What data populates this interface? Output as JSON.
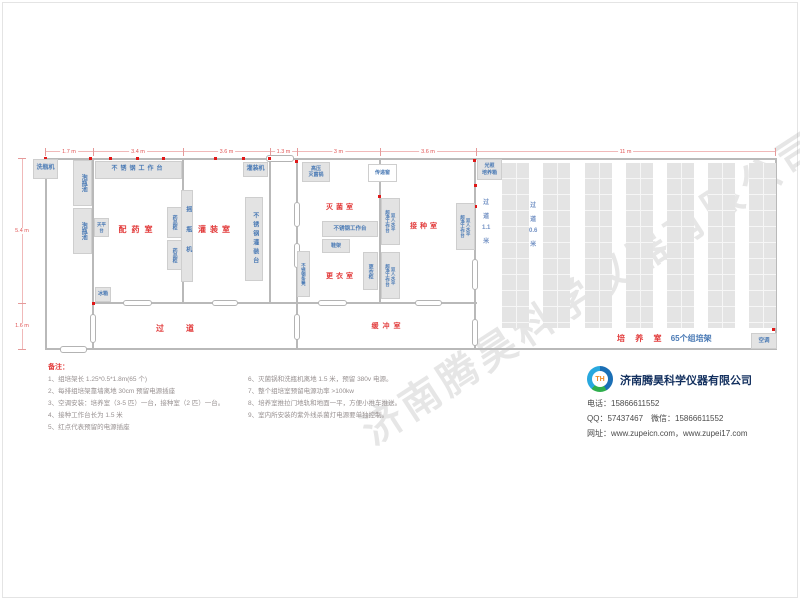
{
  "watermark": "济南腾昊科学仪器有限公司",
  "diagram": {
    "colors": {
      "wall": "#b9b9b9",
      "room_label": "#e23b3b",
      "equip_text": "#4a7ab5",
      "outlet": "#e01818",
      "dimension": "#e05555"
    },
    "walls": [
      {
        "x": 45,
        "y": 158,
        "w": 732,
        "h": 2
      },
      {
        "x": 93,
        "y": 302,
        "w": 384,
        "h": 2
      },
      {
        "x": 45,
        "y": 348,
        "w": 732,
        "h": 2
      },
      {
        "x": 45,
        "y": 158,
        "w": 2,
        "h": 192
      },
      {
        "x": 92,
        "y": 158,
        "w": 2,
        "h": 192
      },
      {
        "x": 182,
        "y": 158,
        "w": 2,
        "h": 146
      },
      {
        "x": 269,
        "y": 158,
        "w": 2,
        "h": 146
      },
      {
        "x": 296,
        "y": 158,
        "w": 2,
        "h": 192
      },
      {
        "x": 379,
        "y": 158,
        "w": 2,
        "h": 146
      },
      {
        "x": 474,
        "y": 158,
        "w": 2,
        "h": 192
      },
      {
        "x": 775,
        "y": 158,
        "w": 2,
        "h": 192
      }
    ],
    "doors": [
      {
        "x": 60,
        "y": 346,
        "w": 27,
        "h": 7
      },
      {
        "x": 123,
        "y": 300,
        "w": 29,
        "h": 6
      },
      {
        "x": 212,
        "y": 300,
        "w": 26,
        "h": 6
      },
      {
        "x": 318,
        "y": 300,
        "w": 29,
        "h": 6
      },
      {
        "x": 415,
        "y": 300,
        "w": 27,
        "h": 6
      },
      {
        "x": 266,
        "y": 155,
        "w": 28,
        "h": 7
      },
      {
        "x": 90,
        "y": 314,
        "w": 6,
        "h": 29
      },
      {
        "x": 294,
        "y": 202,
        "w": 6,
        "h": 25
      },
      {
        "x": 294,
        "y": 243,
        "w": 6,
        "h": 25
      },
      {
        "x": 294,
        "y": 314,
        "w": 6,
        "h": 26
      },
      {
        "x": 472,
        "y": 259,
        "w": 6,
        "h": 31
      },
      {
        "x": 472,
        "y": 319,
        "w": 6,
        "h": 27
      }
    ],
    "outlets": [
      {
        "x": 44,
        "y": 157
      },
      {
        "x": 89,
        "y": 157
      },
      {
        "x": 109,
        "y": 157
      },
      {
        "x": 136,
        "y": 157
      },
      {
        "x": 162,
        "y": 157
      },
      {
        "x": 214,
        "y": 157
      },
      {
        "x": 242,
        "y": 157
      },
      {
        "x": 268,
        "y": 157
      },
      {
        "x": 295,
        "y": 160
      },
      {
        "x": 378,
        "y": 164
      },
      {
        "x": 378,
        "y": 195
      },
      {
        "x": 473,
        "y": 159
      },
      {
        "x": 474,
        "y": 184
      },
      {
        "x": 474,
        "y": 205
      },
      {
        "x": 92,
        "y": 302
      },
      {
        "x": 772,
        "y": 328
      }
    ],
    "dims_top": [
      {
        "label": "1.7 m",
        "x1": 45,
        "x2": 93
      },
      {
        "label": "3.4 m",
        "x1": 93,
        "x2": 183
      },
      {
        "label": "3.6 m",
        "x1": 183,
        "x2": 270
      },
      {
        "label": "1.3 m",
        "x1": 270,
        "x2": 297
      },
      {
        "label": "3 m",
        "x1": 297,
        "x2": 380
      },
      {
        "label": "3.6 m",
        "x1": 380,
        "x2": 476
      },
      {
        "label": "11 m",
        "x1": 476,
        "x2": 775
      }
    ],
    "dims_left": [
      {
        "label": "5.4 m",
        "y1": 158,
        "y2": 303
      },
      {
        "label": "1.6 m",
        "y1": 303,
        "y2": 349
      }
    ],
    "rooms": [
      {
        "name": "peiyao",
        "label": "配药室",
        "x": 138,
        "y": 224,
        "fs": 8,
        "ls": 5
      },
      {
        "name": "guanzhuang",
        "label": "灌装室",
        "x": 216,
        "y": 224,
        "fs": 8,
        "ls": 4
      },
      {
        "name": "miejun",
        "label": "灭菌室",
        "x": 341,
        "y": 202,
        "fs": 7,
        "ls": 3
      },
      {
        "name": "gengyi",
        "label": "更衣室",
        "x": 341,
        "y": 271,
        "fs": 7,
        "ls": 3
      },
      {
        "name": "jiezhong",
        "label": "接种室",
        "x": 425,
        "y": 221,
        "fs": 7,
        "ls": 3
      },
      {
        "name": "guodao",
        "label": "过道",
        "x": 186,
        "y": 323,
        "fs": 8,
        "ls": 22
      },
      {
        "name": "huanchong",
        "label": "缓冲室",
        "x": 388,
        "y": 321,
        "fs": 7,
        "ls": 4
      }
    ],
    "equipment": [
      {
        "name": "bottle-washer",
        "label": "洗瓶机",
        "x": 33,
        "y": 159,
        "w": 25,
        "h": 20,
        "dir": "h",
        "fs": 6
      },
      {
        "name": "soak-pool",
        "label": "泡瓶池",
        "x": 73,
        "y": 160,
        "w": 19,
        "h": 46,
        "dir": "v",
        "fs": 6
      },
      {
        "name": "soak-pool",
        "label": "泡瓶池",
        "x": 73,
        "y": 208,
        "w": 19,
        "h": 46,
        "dir": "v",
        "fs": 6
      },
      {
        "name": "ss-workbench",
        "label": "不锈钢工作台",
        "x": 95,
        "y": 161,
        "w": 87,
        "h": 18,
        "dir": "h",
        "fs": 6,
        "ls": 3
      },
      {
        "name": "balance-table",
        "label": "天平台",
        "x": 94,
        "y": 218,
        "w": 15,
        "h": 19,
        "dir": "h",
        "fs": 4.5
      },
      {
        "name": "medicine-cabinet",
        "label": "药品柜",
        "x": 167,
        "y": 207,
        "w": 15,
        "h": 31,
        "dir": "v",
        "fs": 5
      },
      {
        "name": "medicine-cabinet",
        "label": "药品柜",
        "x": 167,
        "y": 240,
        "w": 15,
        "h": 30,
        "dir": "v",
        "fs": 5
      },
      {
        "name": "fridge",
        "label": "冰箱",
        "x": 95,
        "y": 287,
        "w": 16,
        "h": 15,
        "dir": "h",
        "fs": 5
      },
      {
        "name": "bottle-shaker",
        "label": "摇瓶机",
        "x": 181,
        "y": 190,
        "w": 12,
        "h": 92,
        "dir": "v",
        "fs": 6,
        "ls": 14
      },
      {
        "name": "filling-machine",
        "label": "灌装机",
        "x": 243,
        "y": 162,
        "w": 25,
        "h": 15,
        "dir": "h",
        "fs": 6
      },
      {
        "name": "ss-filling-table",
        "label": "不锈钢灌装台",
        "x": 245,
        "y": 197,
        "w": 18,
        "h": 84,
        "dir": "v",
        "fs": 6,
        "ls": 3
      },
      {
        "name": "autoclave",
        "label": "高压\n灭菌锅",
        "x": 302,
        "y": 162,
        "w": 28,
        "h": 20,
        "dir": "lines",
        "fs": 5
      },
      {
        "name": "pass-window",
        "label": "传递窗",
        "x": 368,
        "y": 164,
        "w": 29,
        "h": 18,
        "dir": "h",
        "fs": 5,
        "white": true
      },
      {
        "name": "ss-workbench",
        "label": "不锈钢工作台",
        "x": 322,
        "y": 221,
        "w": 56,
        "h": 16,
        "dir": "h",
        "fs": 5.5
      },
      {
        "name": "shoe-rack",
        "label": "鞋架",
        "x": 322,
        "y": 239,
        "w": 28,
        "h": 14,
        "dir": "h",
        "fs": 5
      },
      {
        "name": "wardrobe",
        "label": "更衣柜",
        "x": 363,
        "y": 252,
        "w": 15,
        "h": 38,
        "dir": "v",
        "fs": 5
      },
      {
        "name": "ss-bench",
        "label": "不锈钢条凳",
        "x": 297,
        "y": 251,
        "w": 13,
        "h": 46,
        "dir": "v",
        "fs": 4.5
      },
      {
        "name": "clean-bench",
        "label": "双人水平\n超净工作台",
        "x": 381,
        "y": 198,
        "w": 19,
        "h": 47,
        "dir": "v2",
        "fs": 4.5
      },
      {
        "name": "clean-bench",
        "label": "双人水平\n超净工作台",
        "x": 381,
        "y": 252,
        "w": 19,
        "h": 47,
        "dir": "v2",
        "fs": 4.5
      },
      {
        "name": "clean-bench",
        "label": "双人水平\n超净工作台",
        "x": 456,
        "y": 203,
        "w": 19,
        "h": 47,
        "dir": "v2",
        "fs": 4.5
      },
      {
        "name": "light-incubator",
        "label": "光照\n培养箱",
        "x": 477,
        "y": 159,
        "w": 25,
        "h": 21,
        "dir": "lines",
        "fs": 5
      },
      {
        "name": "air-conditioner",
        "label": "空调",
        "x": 751,
        "y": 333,
        "w": 26,
        "h": 16,
        "dir": "h",
        "fs": 5.5
      }
    ],
    "racks": {
      "xs": [
        502,
        543,
        585,
        626,
        667,
        708,
        749
      ],
      "y": 163,
      "w": 27,
      "h": 165
    },
    "rack_corridors": [
      {
        "x": 482,
        "y": 197,
        "items": [
          "过",
          "道",
          "1.1",
          "米"
        ]
      },
      {
        "x": 529,
        "y": 200,
        "items": [
          "过",
          "道",
          "0.6",
          "米"
        ]
      }
    ],
    "culture_label": {
      "red": "培 养 室",
      "blue": "65个组培架"
    }
  },
  "notes": {
    "header": "备注：",
    "col1": [
      "1、组培架长 1.25*0.5*1.8m(65 个)",
      "2、每排组培架靠墙离地 30cm 预留电源插座",
      "3、空调安装：培养室（3-5 匹）一台，接种室（2 匹）一台。",
      "4、接种工作台长为 1.5 米",
      "5、红点代表预留的电源插座"
    ],
    "col2": [
      "6、灭菌锅和洗瓶机离地 1.5 米，预留 380v 电源。",
      "7、整个组培室预留电源功率 >100kw",
      "8、培养室推拉门地轨和地面一平，方便小推车推送。",
      "9、室内所安装的紫外线杀菌灯电源要单独控制。"
    ]
  },
  "company": {
    "logo_text": "TH",
    "name": "济南腾昊科学仪器有限公司",
    "phone": "电话：15866611552",
    "qq_wechat": "QQ：57437467　微信：15866611552",
    "web": "网址：www.zupeicn.com，www.zupei17.com"
  }
}
